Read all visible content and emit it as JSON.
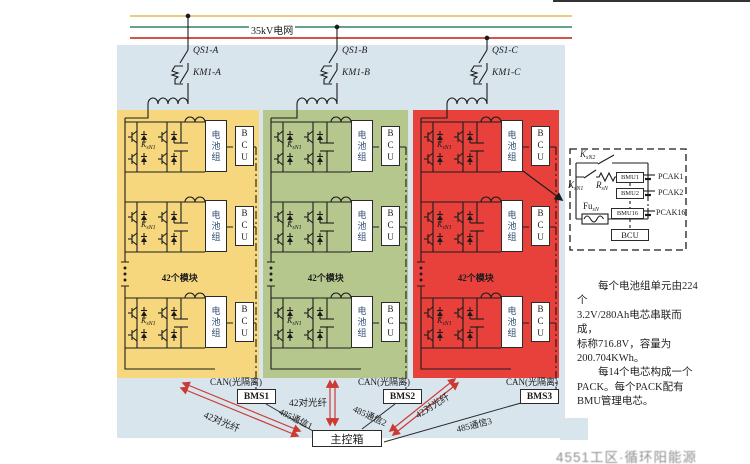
{
  "grid": {
    "label": "35kV电网"
  },
  "phases": [
    {
      "qs": "QS1-A",
      "km": "KM1-A"
    },
    {
      "qs": "QS1-B",
      "km": "KM1-B"
    },
    {
      "qs": "QS1-C",
      "km": "KM1-C"
    }
  ],
  "module": {
    "battery": "电池组",
    "bcu": "BCU",
    "k_base": "K",
    "k_sub": "sN1",
    "count_label": "42个模块"
  },
  "columns": [
    {
      "name": "phase-a-column",
      "color": "#f6d77d"
    },
    {
      "name": "phase-b-column",
      "color": "#b6c78d"
    },
    {
      "name": "phase-c-column",
      "color": "#e8413c"
    }
  ],
  "bottom": {
    "can": "CAN(光隔离)",
    "bms": [
      "BMS1",
      "BMS2",
      "BMS3"
    ],
    "rs485": [
      "485通信1",
      "485通信2",
      "485通信3"
    ],
    "fiber": "42对光纤",
    "main_box": "主控箱"
  },
  "detail": {
    "k2_base": "K",
    "k2_sub": "sN2",
    "k1_base": "K",
    "k1_sub": "sN1",
    "r_base": "R",
    "r_sub": "sN",
    "fu_base": "Fu",
    "fu_sub": "sN",
    "bmu": [
      "BMU1",
      "BMU2",
      "BMU16"
    ],
    "pack": [
      "PCAK1",
      "PCAK2",
      "PCAK16"
    ],
    "bcu": "BCU"
  },
  "note": {
    "lines": [
      "每个电池组单元由224个",
      "3.2V/280Ah电芯串联而成，",
      "标称716.8V，容量为",
      "200.704KWh。",
      "每14个电芯构成一个",
      "PACK。每个PACK配有",
      "BMU管理电芯。"
    ]
  },
  "watermark": "4551工区·循环阳能源",
  "colors": {
    "panel": "#d8e5ed",
    "line_yellow": "#e8cd7e",
    "line_green": "#65a287",
    "line_red": "#d4544c",
    "circuit": "#1c1c1c",
    "arrow_red": "#cc3a34"
  }
}
